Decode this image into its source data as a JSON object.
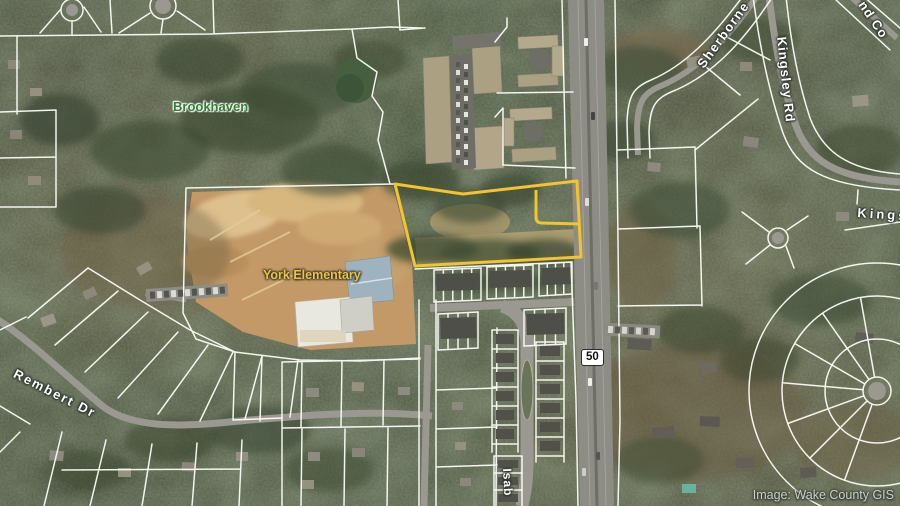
{
  "map": {
    "place_labels": {
      "neighborhood": "Brookhaven",
      "school": "York Elementary"
    },
    "street_labels": {
      "rembert": "Rembert Dr",
      "sherborne": "Sherborne",
      "kingsley": "Kingsley Rd",
      "kings_partial": "Kings",
      "nd_co_partial": "nd Co",
      "isab_partial": "Isab"
    },
    "route_shield": {
      "number": "50"
    },
    "attribution": "Image: Wake County GIS",
    "colors": {
      "highlight_parcel": "#f2c42d",
      "parcel_line": "#fcfcf8",
      "neighborhood_label": "#2f8030",
      "school_label": "#e7c44c",
      "street_label": "#ffffff",
      "shield_bg": "#ffffff",
      "shield_text": "#111111",
      "attribution_text": "#ccd2cb"
    }
  }
}
